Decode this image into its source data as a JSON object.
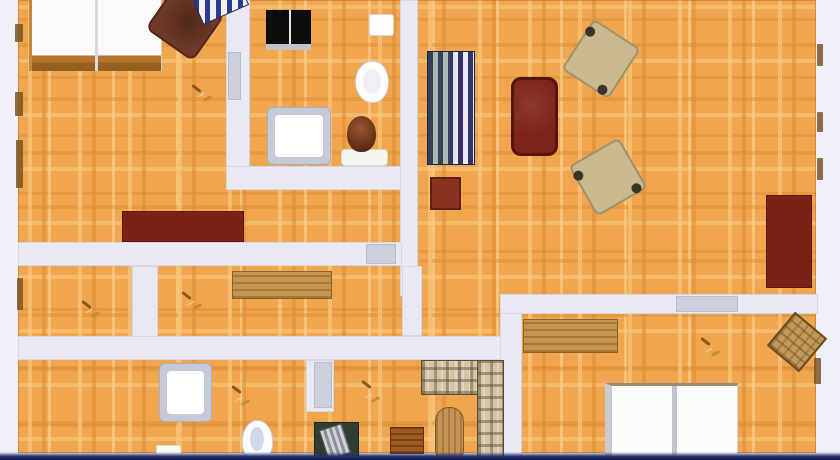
{
  "scene": {
    "type": "apartment-floor-plan-top-view",
    "canvas": {
      "width": 840,
      "height": 460
    },
    "colors": {
      "background": "#eff0f7",
      "floor_base": "#f0a64e",
      "wall": "#e9e9f4",
      "door": "#ccd0dd",
      "red_furniture": "#7b2215",
      "wood": "#c3954e",
      "plaid": "#d2c6a6"
    }
  },
  "base": [
    {
      "kind": "floor",
      "name": "parquet-floor",
      "x": 18,
      "y": 0,
      "w": 798,
      "h": 453
    }
  ],
  "rooms": [
    {
      "kind": "room",
      "name": "room-bedroom-top-left",
      "x": 28,
      "y": 0,
      "w": 200,
      "h": 242
    },
    {
      "kind": "room",
      "name": "room-bathroom-top",
      "x": 250,
      "y": 0,
      "w": 150,
      "h": 166
    },
    {
      "kind": "room",
      "name": "room-living-hall",
      "x": 418,
      "y": 0,
      "w": 398,
      "h": 294
    },
    {
      "kind": "room",
      "name": "room-small-left",
      "x": 18,
      "y": 266,
      "w": 114,
      "h": 70
    },
    {
      "kind": "room",
      "name": "room-study-middle",
      "x": 158,
      "y": 266,
      "w": 244,
      "h": 70
    },
    {
      "kind": "room",
      "name": "corridor",
      "x": 422,
      "y": 266,
      "w": 78,
      "h": 70
    },
    {
      "kind": "room",
      "name": "room-bottom-left",
      "x": 18,
      "y": 360,
      "w": 114,
      "h": 95
    },
    {
      "kind": "room",
      "name": "room-bathroom-bottom",
      "x": 158,
      "y": 360,
      "w": 148,
      "h": 95
    },
    {
      "kind": "room",
      "name": "room-family-bottom",
      "x": 335,
      "y": 360,
      "w": 165,
      "h": 95
    },
    {
      "kind": "room",
      "name": "room-bedroom-bottom-right",
      "x": 522,
      "y": 314,
      "w": 294,
      "h": 141
    }
  ],
  "walls": [
    {
      "kind": "wall",
      "name": "wall-bathroom-left",
      "x": 226,
      "y": 0,
      "w": 24,
      "h": 190
    },
    {
      "kind": "wall",
      "name": "wall-bathroom-bottom",
      "x": 226,
      "y": 166,
      "w": 192,
      "h": 24
    },
    {
      "kind": "wall",
      "name": "wall-central-vertical",
      "x": 400,
      "y": 0,
      "w": 18,
      "h": 296
    },
    {
      "kind": "wall",
      "name": "wall-bedroom-bottom",
      "x": 18,
      "y": 242,
      "w": 384,
      "h": 24
    },
    {
      "kind": "wall",
      "name": "wall-left-divider",
      "x": 132,
      "y": 266,
      "w": 26,
      "h": 94
    },
    {
      "kind": "wall",
      "name": "wall-mid-horizontal",
      "x": 18,
      "y": 336,
      "w": 504,
      "h": 24
    },
    {
      "kind": "wall",
      "name": "wall-central-stub",
      "x": 402,
      "y": 266,
      "w": 20,
      "h": 70
    },
    {
      "kind": "wall",
      "name": "wall-bath2-right",
      "x": 306,
      "y": 360,
      "w": 28,
      "h": 52
    },
    {
      "kind": "wall",
      "name": "wall-bottom-right-vertical",
      "x": 500,
      "y": 296,
      "w": 22,
      "h": 164
    },
    {
      "kind": "wall",
      "name": "wall-bottom-bedroom-top",
      "x": 500,
      "y": 294,
      "w": 318,
      "h": 20
    }
  ],
  "doors": [
    {
      "kind": "door",
      "name": "door-bathroom-top",
      "x": 228,
      "y": 52,
      "w": 13,
      "h": 48
    },
    {
      "kind": "door",
      "name": "door-bedroom-top-left",
      "x": 366,
      "y": 244,
      "w": 30,
      "h": 20
    },
    {
      "kind": "door",
      "name": "door-bathroom-bottom",
      "x": 314,
      "y": 362,
      "w": 18,
      "h": 46
    },
    {
      "kind": "door",
      "name": "door-bedroom-bottom-right",
      "x": 676,
      "y": 296,
      "w": 62,
      "h": 16
    }
  ],
  "furniture": [
    {
      "kind": "bed1",
      "name": "double-bed-top-left",
      "x": 29,
      "y": 0,
      "w": 133,
      "h": 71
    },
    {
      "kind": "armchair-brown",
      "name": "armchair-brown",
      "x": 156,
      "y": -6,
      "w": 58,
      "h": 56,
      "r": 35
    },
    {
      "kind": "striped-bench",
      "name": "striped-bench",
      "x": 196,
      "y": -10,
      "w": 50,
      "h": 26,
      "r": -24
    },
    {
      "kind": "dresser-red",
      "name": "dresser-dark-red",
      "x": 122,
      "y": 211,
      "w": 122,
      "h": 31
    },
    {
      "kind": "stove-black",
      "name": "stove-black",
      "x": 266,
      "y": 10,
      "w": 45,
      "h": 40
    },
    {
      "kind": "sink-top",
      "name": "sink-small",
      "x": 369,
      "y": 14,
      "w": 25,
      "h": 22
    },
    {
      "kind": "toilet",
      "name": "toilet",
      "x": 355,
      "y": 61,
      "w": 34,
      "h": 42
    },
    {
      "kind": "shower",
      "name": "shower-tray-top",
      "x": 267,
      "y": 107,
      "w": 64,
      "h": 58
    },
    {
      "kind": "pedestal",
      "name": "plant-pedestal",
      "x": 341,
      "y": 149,
      "w": 47,
      "h": 17
    },
    {
      "kind": "vase",
      "name": "plant-vase",
      "x": 347,
      "y": 116,
      "w": 29,
      "h": 36
    },
    {
      "kind": "striped-sofa",
      "name": "sofa-striped-blue",
      "x": 427,
      "y": 51,
      "w": 48,
      "h": 114
    },
    {
      "kind": "table-red",
      "name": "side-table-red",
      "x": 430,
      "y": 177,
      "w": 31,
      "h": 33
    },
    {
      "kind": "sofa-red",
      "name": "sofa-dark-red",
      "x": 511,
      "y": 77,
      "w": 47,
      "h": 79
    },
    {
      "kind": "armchair-beige",
      "name": "armchair-beige-1",
      "x": 573,
      "y": 29,
      "w": 56,
      "h": 60,
      "r": 33
    },
    {
      "kind": "armchair-beige",
      "name": "armchair-beige-2",
      "x": 579,
      "y": 148,
      "w": 58,
      "h": 58,
      "r": -30
    },
    {
      "kind": "wardrobe-red",
      "name": "wardrobe-dark-red",
      "x": 766,
      "y": 195,
      "w": 46,
      "h": 93
    },
    {
      "kind": "desk-wood",
      "name": "desk-wooden",
      "x": 232,
      "y": 271,
      "w": 100,
      "h": 28
    },
    {
      "kind": "shower",
      "name": "shower-tray-bottom",
      "x": 159,
      "y": 363,
      "w": 53,
      "h": 59
    },
    {
      "kind": "mat-white",
      "name": "bath-mat",
      "x": 156,
      "y": 445,
      "w": 25,
      "h": 15
    },
    {
      "kind": "basin",
      "name": "wash-basin",
      "x": 242,
      "y": 420,
      "w": 31,
      "h": 40
    },
    {
      "kind": "desk-green",
      "name": "desk-green",
      "x": 314,
      "y": 422,
      "w": 45,
      "h": 38
    },
    {
      "kind": "crate-wood",
      "name": "crate-wooden",
      "x": 390,
      "y": 427,
      "w": 34,
      "h": 27
    },
    {
      "kind": "oval-table",
      "name": "oval-table-wooden",
      "x": 435,
      "y": 407,
      "w": 29,
      "h": 53
    },
    {
      "kind": "plaid plaid-h",
      "name": "corner-sofa-plaid-horizontal",
      "x": 421,
      "y": 360,
      "w": 82,
      "h": 35
    },
    {
      "kind": "plaid",
      "name": "corner-sofa-plaid-vertical",
      "x": 477,
      "y": 360,
      "w": 27,
      "h": 100
    },
    {
      "kind": "bench-wood",
      "name": "sideboard-wooden",
      "x": 523,
      "y": 319,
      "w": 95,
      "h": 34
    },
    {
      "kind": "bed2",
      "name": "double-bed-bottom-right",
      "x": 605,
      "y": 383,
      "w": 133,
      "h": 77
    },
    {
      "kind": "chair-wood",
      "name": "chair-wooden-rotated",
      "x": 776,
      "y": 320,
      "w": 42,
      "h": 44,
      "r": 40
    }
  ],
  "icons": [
    {
      "kind": "door-icon",
      "name": "door-handle-icon",
      "x": 190,
      "y": 84,
      "w": 22,
      "h": 18
    },
    {
      "kind": "door-icon",
      "name": "door-handle-icon",
      "x": 80,
      "y": 300,
      "w": 20,
      "h": 18
    },
    {
      "kind": "door-icon",
      "name": "door-handle-icon",
      "x": 180,
      "y": 291,
      "w": 22,
      "h": 19
    },
    {
      "kind": "door-icon",
      "name": "door-handle-icon",
      "x": 230,
      "y": 385,
      "w": 20,
      "h": 21
    },
    {
      "kind": "door-icon",
      "name": "door-handle-icon",
      "x": 360,
      "y": 380,
      "w": 20,
      "h": 23
    },
    {
      "kind": "door-icon",
      "name": "door-handle-icon",
      "x": 699,
      "y": 337,
      "w": 21,
      "h": 20
    }
  ],
  "windows": [
    {
      "kind": "window-mark",
      "name": "window-left-1",
      "x": 15,
      "y": 24,
      "w": 8,
      "h": 18
    },
    {
      "kind": "window-mark",
      "name": "window-left-2",
      "x": 15,
      "y": 92,
      "w": 8,
      "h": 24
    },
    {
      "kind": "window-mark",
      "name": "window-left-3",
      "x": 16,
      "y": 140,
      "w": 7,
      "h": 48
    },
    {
      "kind": "window-mark",
      "name": "window-left-4",
      "x": 17,
      "y": 278,
      "w": 6,
      "h": 32
    },
    {
      "kind": "window-mark",
      "name": "window-right-1",
      "x": 817,
      "y": 44,
      "w": 6,
      "h": 22
    },
    {
      "kind": "window-mark",
      "name": "window-right-2",
      "x": 817,
      "y": 112,
      "w": 6,
      "h": 20
    },
    {
      "kind": "window-mark",
      "name": "window-right-3",
      "x": 817,
      "y": 158,
      "w": 6,
      "h": 22
    },
    {
      "kind": "window-mark",
      "name": "window-right-4",
      "x": 814,
      "y": 358,
      "w": 7,
      "h": 26
    }
  ],
  "edges": [
    {
      "kind": "photo-edge",
      "name": "photo-bottom-edge",
      "x": 0,
      "y": 452,
      "w": 840,
      "h": 8
    }
  ]
}
